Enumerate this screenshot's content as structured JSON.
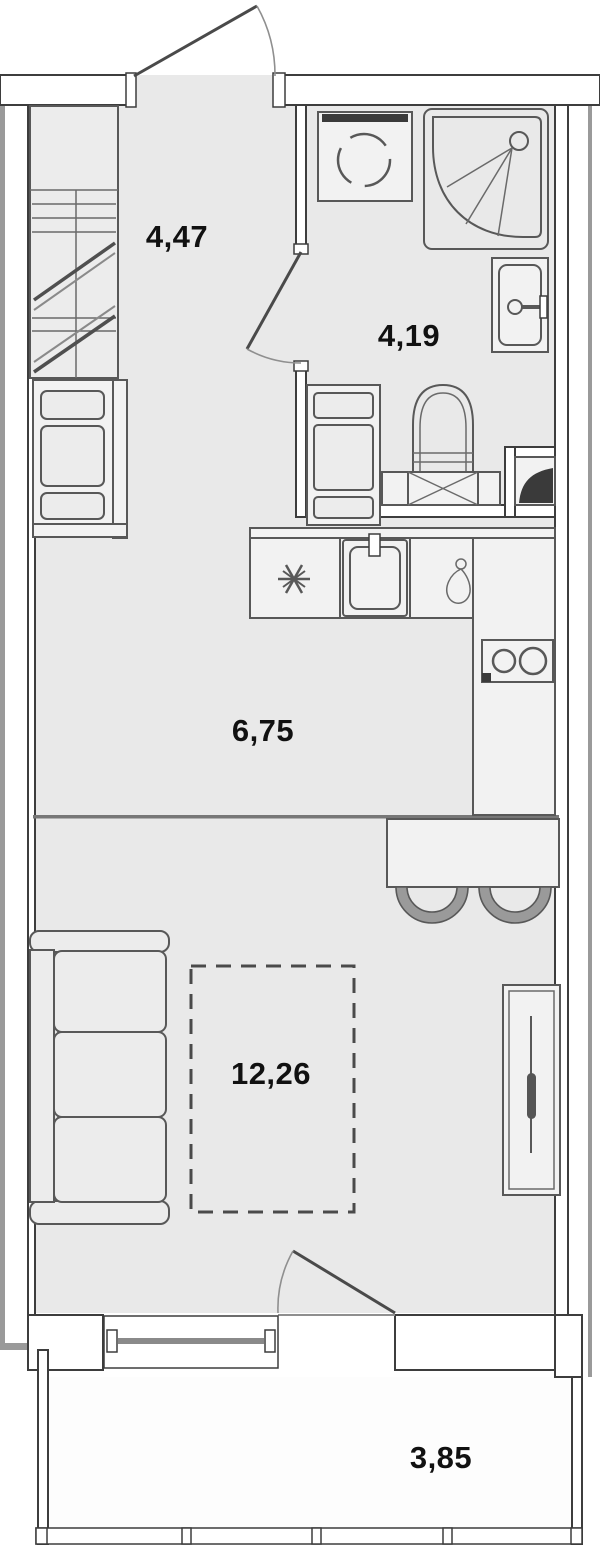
{
  "rooms": {
    "hallway": {
      "label": "4,47"
    },
    "bathroom": {
      "label": "4,19"
    },
    "kitchen": {
      "label": "6,75"
    },
    "living": {
      "label": "12,26"
    },
    "balcony": {
      "label": "3,85"
    }
  },
  "colors": {
    "floor": "#e9e9e9",
    "wall_fill": "#ffffff",
    "wall_outline": "#3d3d3d",
    "fixture_outline": "#585858",
    "context_gray": "#9a9a9a",
    "label_text": "#111111"
  },
  "fixture_icons": [
    "entry-door-icon",
    "wardrobe-icon",
    "dresser-icon",
    "washing-machine-icon",
    "shower-icon",
    "washbasin-icon",
    "toilet-icon",
    "vent-shaft-icon",
    "bathroom-door-icon",
    "fridge-snowflake-icon",
    "kitchen-sink-icon",
    "water-drop-icon",
    "stove-icon",
    "bar-counter-icon",
    "bar-stool-icon",
    "sofa-icon",
    "bed-dashed-outline-icon",
    "tall-cabinet-icon",
    "balcony-door-icon",
    "window-icon",
    "balcony-glazing-icon"
  ]
}
